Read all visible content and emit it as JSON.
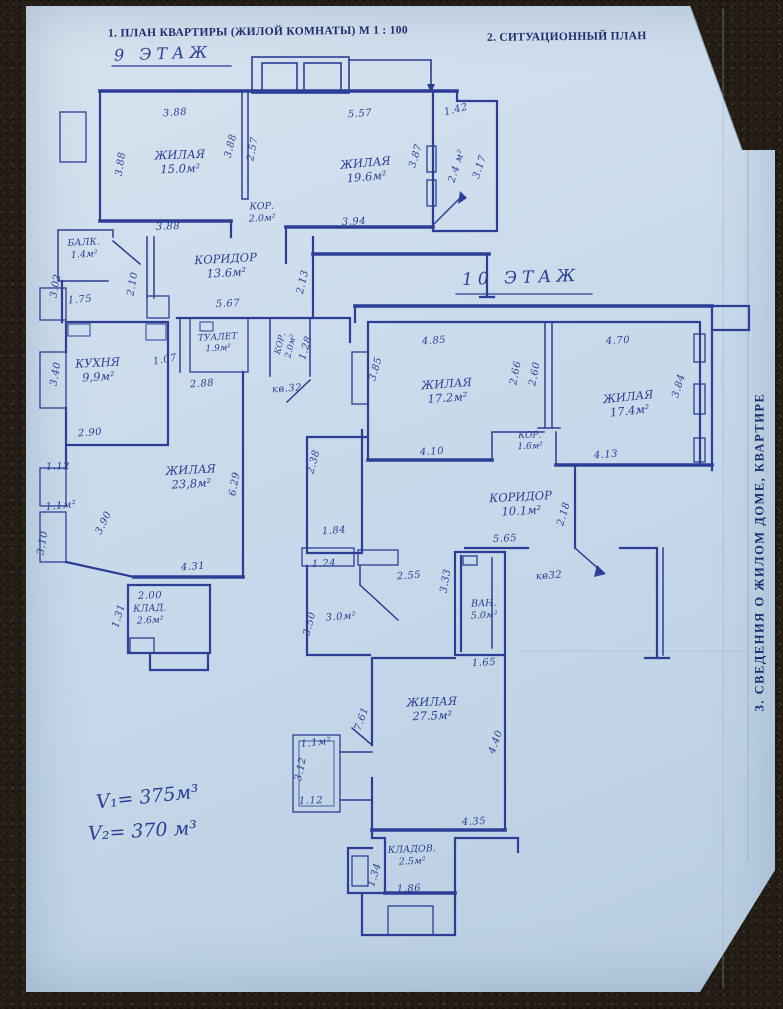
{
  "document": {
    "header_left": "1. ПЛАН КВАРТИРЫ (ЖИЛОЙ КОМНАТЫ) М 1 : 100",
    "header_right": "2. СИТУАЦИОННЫЙ ПЛАН",
    "side_section_title": "3. СВЕДЕНИЯ  О  ЖИЛОМ  ДОМЕ,  КВАРТИРЕ",
    "volume_note_1": "V₁= 375м³",
    "volume_note_2": "V₂= 370 м³"
  },
  "colors": {
    "ink": "#2c3e95",
    "print_ink": "#1d2d70",
    "paper": "#cbdcec",
    "carpet": "#241d16"
  },
  "plans": [
    {
      "title": "9 ЭТАЖ",
      "apartment_ref": "кв.32",
      "rooms": [
        {
          "name": "ЖИЛАЯ",
          "area": "15.0м²",
          "x": 180,
          "y": 162,
          "r": -2
        },
        {
          "name": "ЖИЛАЯ",
          "area": "19.6м²",
          "x": 366,
          "y": 170,
          "r": -5
        },
        {
          "name": "БАЛК.",
          "area": "1.4м²",
          "x": 84,
          "y": 249,
          "r": -3,
          "size": 9.5
        },
        {
          "name": "КОРИДОР",
          "area": "13.6м²",
          "x": 226,
          "y": 266,
          "r": -3
        },
        {
          "name": "КОР.",
          "area": "2.0м²",
          "x": 262,
          "y": 213,
          "r": -2,
          "size": 9.5
        },
        {
          "name": "ТУАЛЕТ",
          "area": "1.9м²",
          "x": 218,
          "y": 344,
          "r": -3,
          "size": 9
        },
        {
          "name": "КОР.",
          "area": "2.0м²",
          "x": 286,
          "y": 345,
          "r": -76,
          "size": 8.5
        },
        {
          "name": "КУХНЯ",
          "area": "9,9м²",
          "x": 98,
          "y": 370,
          "r": -3
        },
        {
          "name": "ЖИЛАЯ",
          "area": "23,8м²",
          "x": 191,
          "y": 477,
          "r": -3
        },
        {
          "name": "КЛАД.",
          "area": "2.6м²",
          "x": 150,
          "y": 615,
          "r": -2,
          "size": 9.5
        }
      ],
      "dims": [
        {
          "t": "3.88",
          "x": 175,
          "y": 113,
          "r": -4
        },
        {
          "t": "5.57",
          "x": 360,
          "y": 114,
          "r": -4
        },
        {
          "t": "1.42",
          "x": 456,
          "y": 110,
          "r": -14
        },
        {
          "t": "3.88",
          "x": 121,
          "y": 164,
          "r": -82
        },
        {
          "t": "3.88",
          "x": 231,
          "y": 146,
          "r": -76
        },
        {
          "t": "2.57",
          "x": 253,
          "y": 149,
          "r": -79
        },
        {
          "t": "3.87",
          "x": 416,
          "y": 156,
          "r": -74
        },
        {
          "t": "2.4 м²",
          "x": 457,
          "y": 166,
          "r": -72
        },
        {
          "t": "3.17",
          "x": 480,
          "y": 167,
          "r": -72
        },
        {
          "t": "3.88",
          "x": 168,
          "y": 227,
          "r": -2
        },
        {
          "t": "3.94",
          "x": 354,
          "y": 222,
          "r": -3
        },
        {
          "t": "3.02",
          "x": 56,
          "y": 286,
          "r": -80
        },
        {
          "t": "1.75",
          "x": 80,
          "y": 300,
          "r": -5
        },
        {
          "t": "2.10",
          "x": 133,
          "y": 284,
          "r": -80
        },
        {
          "t": "2.13",
          "x": 303,
          "y": 282,
          "r": -77
        },
        {
          "t": "5.67",
          "x": 228,
          "y": 304,
          "r": -3
        },
        {
          "t": "1.07",
          "x": 165,
          "y": 360,
          "r": -10
        },
        {
          "t": "2.88",
          "x": 202,
          "y": 384,
          "r": -4
        },
        {
          "t": "1.28",
          "x": 306,
          "y": 348,
          "r": -74
        },
        {
          "t": "кв.32",
          "x": 287,
          "y": 389,
          "r": -4
        },
        {
          "t": "3.40",
          "x": 56,
          "y": 374,
          "r": -80
        },
        {
          "t": "2.90",
          "x": 90,
          "y": 433,
          "r": -4
        },
        {
          "t": "1.12",
          "x": 58,
          "y": 467,
          "r": -2
        },
        {
          "t": "1.1м²",
          "x": 61,
          "y": 506,
          "r": -5
        },
        {
          "t": "3.10",
          "x": 43,
          "y": 543,
          "r": -80
        },
        {
          "t": "3.90",
          "x": 104,
          "y": 523,
          "r": -64
        },
        {
          "t": "6.29",
          "x": 235,
          "y": 484,
          "r": -80
        },
        {
          "t": "4.31",
          "x": 193,
          "y": 567,
          "r": -4
        },
        {
          "t": "2.00",
          "x": 150,
          "y": 596,
          "r": -2
        },
        {
          "t": "1.31",
          "x": 119,
          "y": 616,
          "r": -74
        }
      ]
    },
    {
      "title": "10 ЭТАЖ",
      "apartment_ref": "кв32",
      "rooms": [
        {
          "name": "ЖИЛАЯ",
          "area": "17.2м²",
          "x": 447,
          "y": 391,
          "r": -4
        },
        {
          "name": "ЖИЛАЯ",
          "area": "17.4м²",
          "x": 629,
          "y": 404,
          "r": -6
        },
        {
          "name": "КОР.",
          "area": "1.6м²",
          "x": 530,
          "y": 442,
          "r": -2,
          "size": 9
        },
        {
          "name": "КОРИДОР",
          "area": "10.1м²",
          "x": 521,
          "y": 504,
          "r": -3
        },
        {
          "name": "ВАН.",
          "area": "5.0м²",
          "x": 484,
          "y": 610,
          "r": -2,
          "size": 9.5
        },
        {
          "name": "ЖИЛАЯ",
          "area": "27.5м²",
          "x": 432,
          "y": 709,
          "r": -2
        },
        {
          "name": "КЛАДОВ.",
          "area": "2.5м²",
          "x": 412,
          "y": 856,
          "r": -2,
          "size": 9.5
        }
      ],
      "dims": [
        {
          "t": "4.85",
          "x": 434,
          "y": 341,
          "r": -4
        },
        {
          "t": "4.70",
          "x": 618,
          "y": 341,
          "r": -3
        },
        {
          "t": "3.85",
          "x": 376,
          "y": 369,
          "r": -74
        },
        {
          "t": "2.66",
          "x": 516,
          "y": 373,
          "r": -79
        },
        {
          "t": "2.60",
          "x": 535,
          "y": 374,
          "r": -79
        },
        {
          "t": "3.84",
          "x": 679,
          "y": 386,
          "r": -74
        },
        {
          "t": "4.10",
          "x": 432,
          "y": 452,
          "r": -3
        },
        {
          "t": "4.13",
          "x": 606,
          "y": 455,
          "r": -4
        },
        {
          "t": "2.18",
          "x": 564,
          "y": 514,
          "r": -74
        },
        {
          "t": "5.65",
          "x": 505,
          "y": 539,
          "r": -3
        },
        {
          "t": "кв32",
          "x": 549,
          "y": 576,
          "r": -4
        },
        {
          "t": "3.33",
          "x": 446,
          "y": 581,
          "r": -80
        },
        {
          "t": "1.65",
          "x": 484,
          "y": 663,
          "r": -3
        },
        {
          "t": "2.38",
          "x": 314,
          "y": 462,
          "r": -75
        },
        {
          "t": "1.84",
          "x": 334,
          "y": 531,
          "r": -4
        },
        {
          "t": "1.24",
          "x": 324,
          "y": 564,
          "r": -3
        },
        {
          "t": "2.55",
          "x": 409,
          "y": 576,
          "r": -4
        },
        {
          "t": "3.50",
          "x": 310,
          "y": 624,
          "r": -75
        },
        {
          "t": "3.0м²",
          "x": 341,
          "y": 617,
          "r": -4
        },
        {
          "t": "7.61",
          "x": 362,
          "y": 719,
          "r": -70
        },
        {
          "t": "4.40",
          "x": 496,
          "y": 742,
          "r": -70
        },
        {
          "t": "4.35",
          "x": 474,
          "y": 822,
          "r": -3
        },
        {
          "t": "1.1м²",
          "x": 316,
          "y": 743,
          "r": -6
        },
        {
          "t": "3.12",
          "x": 301,
          "y": 769,
          "r": -78
        },
        {
          "t": "1.12",
          "x": 311,
          "y": 801,
          "r": -2
        },
        {
          "t": "1.34",
          "x": 375,
          "y": 875,
          "r": -74
        },
        {
          "t": "1.86",
          "x": 409,
          "y": 889,
          "r": -3
        }
      ]
    }
  ]
}
